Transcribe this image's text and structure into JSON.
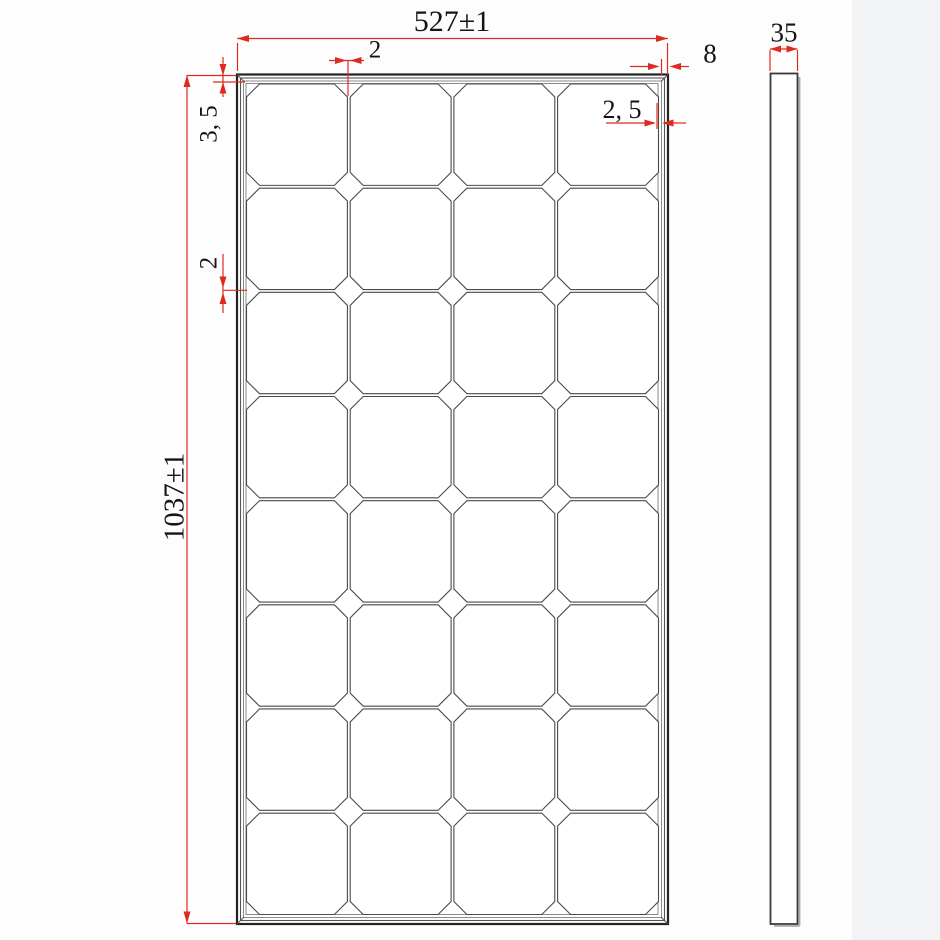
{
  "drawing": {
    "type": "solar-panel-technical-drawing",
    "panel": {
      "grid": {
        "rows": 8,
        "cols": 4
      },
      "dimensions": {
        "width": "527±1",
        "height": "1037±1",
        "thickness": "35",
        "frame_width": "8",
        "cell_gap_top": "2",
        "cell_gap_side": "2",
        "cell_edge_gap": "2, 5",
        "frame_top_margin": "3, 5"
      }
    },
    "colors": {
      "dimension_red": "#dd2b20",
      "line_dark": "#222222",
      "line_mid": "#555555",
      "line_light": "#888888",
      "text": "#141414"
    }
  }
}
